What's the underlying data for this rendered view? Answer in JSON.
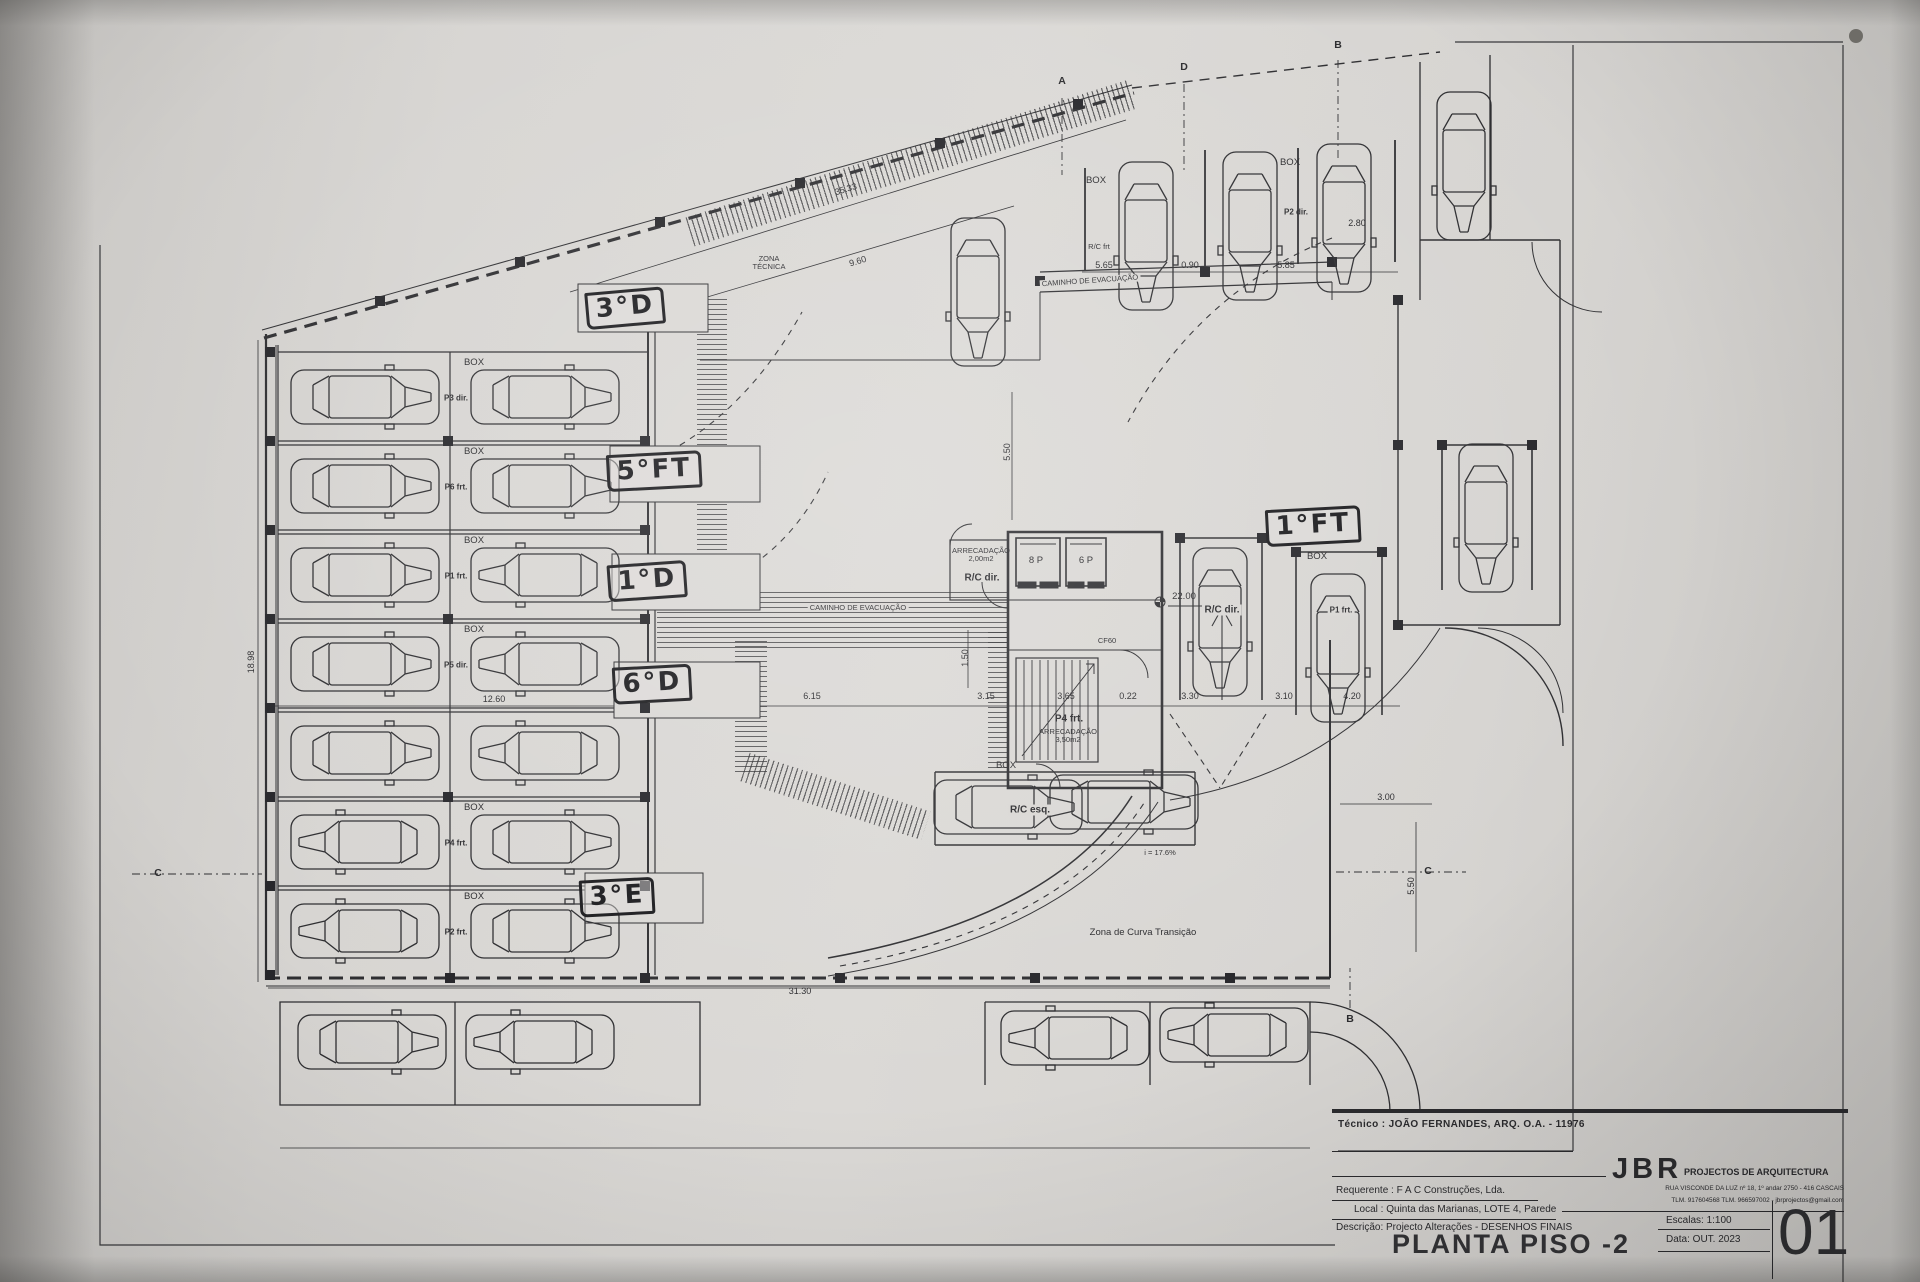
{
  "photo": {
    "paper_color": "#d8d6d3",
    "ink_color": "#2e2e31",
    "marker_ink": "#1b1b1e"
  },
  "title_block": {
    "tecnico": "Técnico : JOÃO FERNANDES, ARQ.    O.A. - 11976",
    "firm": "JBR",
    "firm_tagline": "PROJECTOS DE ARQUITECTURA",
    "addr1": "RUA VISCONDE DA LUZ nº 18, 1º andar  2750 - 416  CASCAIS",
    "addr2": "TLM. 917604568  TLM. 966597002 - jbrprojectos@gmail.com",
    "requerente": "Requerente : F A C  Construções, Lda.",
    "local": "Local : Quinta das Marianas, LOTE 4, Parede",
    "descricao": "Descrição:  Projecto Alterações - DESENHOS FINAIS",
    "drawing_title": "PLANTA PISO -2",
    "escalas": "Escalas:  1:100",
    "data": "Data: OUT.  2023",
    "sheet_number": "01"
  },
  "plan": {
    "handwritten": [
      {
        "t": "3°D",
        "x": 625,
        "y": 308,
        "r": -5
      },
      {
        "t": "5°FT",
        "x": 654,
        "y": 471,
        "r": -3
      },
      {
        "t": "1°D",
        "x": 647,
        "y": 581,
        "r": -4
      },
      {
        "t": "6°D",
        "x": 652,
        "y": 684,
        "r": -3
      },
      {
        "t": "3°E",
        "x": 617,
        "y": 897,
        "r": -3
      },
      {
        "t": "1°FT",
        "x": 1313,
        "y": 526,
        "r": -3
      }
    ],
    "annotations": [
      {
        "t": "ZONA\nTÉCNICA",
        "x": 769,
        "y": 263,
        "c": "xs",
        "n": "zona-tecnica-label"
      },
      {
        "t": "CAMINHO  DE  EVACUAÇÃO",
        "x": 1090,
        "y": 281,
        "c": "xs w",
        "r": -4,
        "n": "caminho-evacuacao-label"
      },
      {
        "t": "CAMINHO  DE  EVACUAÇÃO",
        "x": 858,
        "y": 608,
        "c": "xs w",
        "n": "caminho-evacuacao-label"
      },
      {
        "t": "BOX",
        "x": 1096,
        "y": 181,
        "c": "s",
        "n": "box-label"
      },
      {
        "t": "R/C frt",
        "x": 1099,
        "y": 247,
        "c": "xs",
        "n": "unit-label"
      },
      {
        "t": "BOX",
        "x": 1290,
        "y": 163,
        "c": "s",
        "n": "box-label"
      },
      {
        "t": "P2 dir.",
        "x": 1296,
        "y": 213,
        "c": "xsb",
        "n": "unit-label"
      },
      {
        "t": "BOX",
        "x": 1317,
        "y": 557,
        "c": "s",
        "n": "box-label"
      },
      {
        "t": "P1 frt.",
        "x": 1341,
        "y": 611,
        "c": "xsb w",
        "n": "unit-label"
      },
      {
        "t": "BOX",
        "x": 1006,
        "y": 766,
        "c": "s",
        "n": "box-label"
      },
      {
        "t": "R/C esq.",
        "x": 1030,
        "y": 810,
        "c": "sb w",
        "n": "unit-label"
      },
      {
        "t": "R/C dir.",
        "x": 1222,
        "y": 610,
        "c": "sb w",
        "n": "unit-label"
      },
      {
        "t": "ARRECADAÇÃO\n2,00m2",
        "x": 981,
        "y": 555,
        "c": "xs",
        "n": "arrecadacao-label"
      },
      {
        "t": "R/C dir.",
        "x": 982,
        "y": 578,
        "c": "sb",
        "n": "unit-label"
      },
      {
        "t": "8 P",
        "x": 1036,
        "y": 561,
        "c": "s",
        "n": "elevator-label"
      },
      {
        "t": "6 P",
        "x": 1086,
        "y": 561,
        "c": "s",
        "n": "elevator-label"
      },
      {
        "t": "CF60",
        "x": 1107,
        "y": 641,
        "c": "xs",
        "n": "fire-door-label"
      },
      {
        "t": "P4 frt.",
        "x": 1069,
        "y": 719,
        "c": "sb",
        "n": "unit-label"
      },
      {
        "t": "ARRECADAÇÃO\n3,50m2",
        "x": 1068,
        "y": 736,
        "c": "xs",
        "n": "arrecadacao-label"
      },
      {
        "t": "i = 17.6%",
        "x": 1160,
        "y": 853,
        "c": "xs",
        "n": "ramp-slope-label"
      },
      {
        "t": "Zona de Curva Transição",
        "x": 1143,
        "y": 933,
        "c": "s",
        "n": "curve-zone-label"
      },
      {
        "t": "22.00",
        "x": 1184,
        "y": 597,
        "c": "s",
        "n": "level-label"
      },
      {
        "t": "BOX",
        "x": 474,
        "y": 363,
        "c": "s",
        "n": "box-label"
      },
      {
        "t": "BOX",
        "x": 474,
        "y": 452,
        "c": "s",
        "n": "box-label"
      },
      {
        "t": "BOX",
        "x": 474,
        "y": 541,
        "c": "s",
        "n": "box-label"
      },
      {
        "t": "BOX",
        "x": 474,
        "y": 630,
        "c": "s",
        "n": "box-label"
      },
      {
        "t": "BOX",
        "x": 474,
        "y": 808,
        "c": "s",
        "n": "box-label"
      },
      {
        "t": "BOX",
        "x": 474,
        "y": 897,
        "c": "s",
        "n": "box-label"
      },
      {
        "t": "P3 dir.",
        "x": 456,
        "y": 399,
        "c": "xsb",
        "n": "unit-label"
      },
      {
        "t": "P6 frt.",
        "x": 456,
        "y": 488,
        "c": "xsb",
        "n": "unit-label"
      },
      {
        "t": "P1 frt.",
        "x": 456,
        "y": 577,
        "c": "xsb",
        "n": "unit-label"
      },
      {
        "t": "P5 dir.",
        "x": 456,
        "y": 666,
        "c": "xsb",
        "n": "unit-label"
      },
      {
        "t": "P4 frt.",
        "x": 456,
        "y": 844,
        "c": "xsb",
        "n": "unit-label"
      },
      {
        "t": "P2 frt.",
        "x": 456,
        "y": 933,
        "c": "xsb",
        "n": "unit-label"
      },
      {
        "t": "35.33",
        "x": 846,
        "y": 190,
        "c": "dim",
        "r": -17,
        "n": "dimension"
      },
      {
        "t": "9.60",
        "x": 858,
        "y": 262,
        "c": "dim",
        "r": -17,
        "n": "dimension"
      },
      {
        "t": "5.65",
        "x": 1104,
        "y": 266,
        "c": "dim",
        "n": "dimension"
      },
      {
        "t": "0.90",
        "x": 1190,
        "y": 266,
        "c": "dim",
        "n": "dimension"
      },
      {
        "t": "5.85",
        "x": 1286,
        "y": 266,
        "c": "dim",
        "n": "dimension"
      },
      {
        "t": "2.80",
        "x": 1357,
        "y": 224,
        "c": "dim",
        "n": "dimension"
      },
      {
        "t": "18.98",
        "x": 252,
        "y": 662,
        "c": "dim",
        "r": -90,
        "n": "dimension"
      },
      {
        "t": "12.60",
        "x": 494,
        "y": 700,
        "c": "dim",
        "n": "dimension"
      },
      {
        "t": "6.15",
        "x": 812,
        "y": 697,
        "c": "dim",
        "n": "dimension"
      },
      {
        "t": "3.15",
        "x": 986,
        "y": 697,
        "c": "dim",
        "n": "dimension"
      },
      {
        "t": "3.65",
        "x": 1066,
        "y": 697,
        "c": "dim",
        "n": "dimension"
      },
      {
        "t": "0.22",
        "x": 1128,
        "y": 697,
        "c": "dim",
        "n": "dimension"
      },
      {
        "t": "3.30",
        "x": 1190,
        "y": 697,
        "c": "dim",
        "n": "dimension"
      },
      {
        "t": "3.10",
        "x": 1284,
        "y": 697,
        "c": "dim",
        "n": "dimension"
      },
      {
        "t": "4.20",
        "x": 1352,
        "y": 697,
        "c": "dim",
        "n": "dimension"
      },
      {
        "t": "31.30",
        "x": 800,
        "y": 992,
        "c": "dim",
        "n": "dimension"
      },
      {
        "t": "3.00",
        "x": 1386,
        "y": 798,
        "c": "dim",
        "n": "dimension"
      },
      {
        "t": "5.50",
        "x": 1412,
        "y": 886,
        "c": "dim",
        "r": -90,
        "n": "dimension"
      },
      {
        "t": "5.50",
        "x": 1008,
        "y": 452,
        "c": "dim",
        "r": -90,
        "n": "dimension"
      },
      {
        "t": "1.50",
        "x": 966,
        "y": 658,
        "c": "dim",
        "r": -90,
        "n": "dimension"
      },
      {
        "t": "A",
        "x": 1062,
        "y": 82,
        "c": "marker",
        "n": "section-marker"
      },
      {
        "t": "D",
        "x": 1184,
        "y": 68,
        "c": "marker",
        "n": "section-marker"
      },
      {
        "t": "B",
        "x": 1338,
        "y": 46,
        "c": "marker",
        "n": "section-marker"
      },
      {
        "t": "C",
        "x": 158,
        "y": 874,
        "c": "marker",
        "n": "section-marker"
      },
      {
        "t": "C",
        "x": 1428,
        "y": 872,
        "c": "marker",
        "n": "section-marker"
      },
      {
        "t": "B",
        "x": 1350,
        "y": 1020,
        "c": "marker",
        "n": "section-marker"
      }
    ]
  }
}
